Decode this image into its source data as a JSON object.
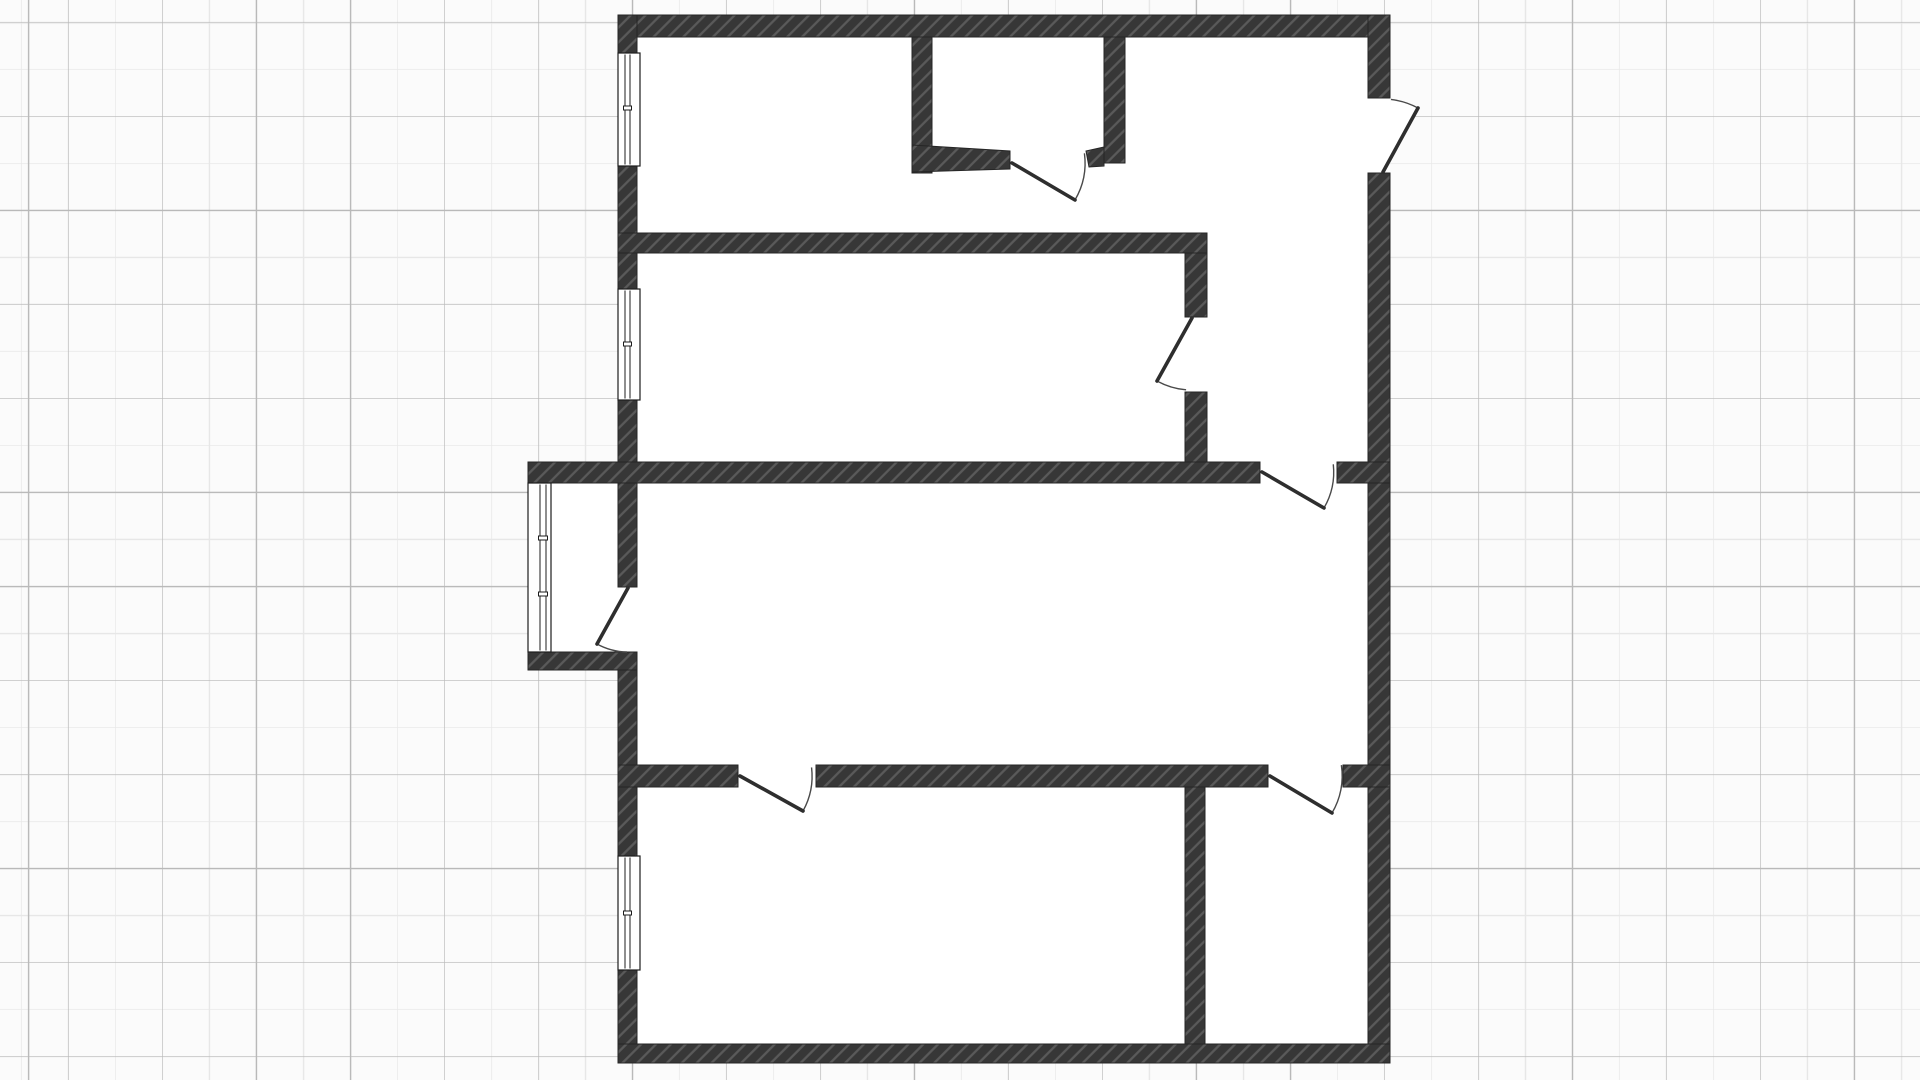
{
  "canvas": {
    "width": 1920,
    "height": 1080,
    "background_color": "#fbfbfb",
    "grid": {
      "minor_spacing": 47,
      "major_spacing": 94,
      "minor_color": "#e7e7e7",
      "major_color": "#b9b9b9",
      "offsets": {
        "major_v": 68,
        "major_h": 22,
        "minor_v": 21,
        "minor_h": 69
      }
    }
  },
  "floor_plan": {
    "style": {
      "wall_fill": "#373737",
      "hatch_line": "#5a5a5a",
      "hatch_spacing": 10.5,
      "hatch_width": 2.3,
      "wall_outline": "#262626",
      "floor_fill": "#ffffff",
      "door_leaf_color": "#2e2e2e",
      "door_leaf_width": 3.6,
      "door_arc_color": "#4a4a4a",
      "door_arc_width": 1.4,
      "window_frame_color": "#1d1d1d"
    },
    "floor_areas": [
      {
        "name": "main-floor",
        "x": 618,
        "y": 15,
        "w": 772,
        "h": 1048
      },
      {
        "name": "balcony-floor",
        "x": 528,
        "y": 463,
        "w": 109,
        "h": 207
      }
    ],
    "walls": [
      {
        "name": "wall-outer-top",
        "x": 618,
        "y": 15,
        "w": 772,
        "h": 22
      },
      {
        "name": "wall-outer-right-upper",
        "x": 1368,
        "y": 15,
        "w": 22,
        "h": 83
      },
      {
        "name": "wall-outer-right-main",
        "x": 1368,
        "y": 173,
        "w": 22,
        "h": 890
      },
      {
        "name": "wall-outer-bottom",
        "x": 618,
        "y": 1044,
        "w": 772,
        "h": 19
      },
      {
        "name": "wall-outer-left-a",
        "x": 618,
        "y": 15,
        "w": 19,
        "h": 38
      },
      {
        "name": "wall-outer-left-b",
        "x": 618,
        "y": 166,
        "w": 19,
        "h": 123
      },
      {
        "name": "wall-outer-left-c",
        "x": 618,
        "y": 400,
        "w": 19,
        "h": 187
      },
      {
        "name": "wall-outer-left-d",
        "x": 618,
        "y": 670,
        "w": 19,
        "h": 186
      },
      {
        "name": "wall-outer-left-e",
        "x": 618,
        "y": 970,
        "w": 19,
        "h": 74
      },
      {
        "name": "wall-divider-upper",
        "x": 618,
        "y": 233,
        "w": 589,
        "h": 20
      },
      {
        "name": "wall-closet-left",
        "x": 912,
        "y": 37,
        "w": 20,
        "h": 136
      },
      {
        "name": "wall-closet-right",
        "x": 1104,
        "y": 37,
        "w": 21,
        "h": 126
      },
      {
        "name": "wall-hall-upper",
        "x": 1185,
        "y": 253,
        "w": 22,
        "h": 64
      },
      {
        "name": "wall-hall-lower",
        "x": 1185,
        "y": 392,
        "w": 22,
        "h": 70
      },
      {
        "name": "wall-living-top-main",
        "x": 528,
        "y": 462,
        "w": 732,
        "h": 21
      },
      {
        "name": "wall-living-top-right",
        "x": 1337,
        "y": 462,
        "w": 53,
        "h": 21
      },
      {
        "name": "wall-balcony-bottom",
        "x": 528,
        "y": 652,
        "w": 109,
        "h": 18
      },
      {
        "name": "wall-living-bottom-left",
        "x": 618,
        "y": 765,
        "w": 120,
        "h": 22
      },
      {
        "name": "wall-living-bottom-mid",
        "x": 816,
        "y": 765,
        "w": 452,
        "h": 22
      },
      {
        "name": "wall-living-bottom-right",
        "x": 1343,
        "y": 765,
        "w": 47,
        "h": 22
      },
      {
        "name": "wall-bottom-divider",
        "x": 1185,
        "y": 787,
        "w": 20,
        "h": 257
      }
    ],
    "wall_polygons": [
      {
        "name": "wall-closet-bottom",
        "points": [
          [
            912,
            145
          ],
          [
            1010,
            151
          ],
          [
            1010,
            169
          ],
          [
            912,
            172
          ]
        ]
      },
      {
        "name": "wall-closet-bottom-stub",
        "points": [
          [
            1086,
            151
          ],
          [
            1104,
            147
          ],
          [
            1104,
            166
          ],
          [
            1089,
            167
          ]
        ]
      }
    ],
    "windows": [
      {
        "name": "window-top-left",
        "x": 618,
        "y": 53,
        "w": 22,
        "h": 113,
        "pane_offsets": [
          7,
          12
        ],
        "ticks": [
          55
        ]
      },
      {
        "name": "window-mid-left",
        "x": 618,
        "y": 289,
        "w": 22,
        "h": 111,
        "pane_offsets": [
          7,
          12
        ],
        "ticks": [
          55
        ]
      },
      {
        "name": "window-bottom-left",
        "x": 618,
        "y": 856,
        "w": 22,
        "h": 114,
        "pane_offsets": [
          7,
          12
        ],
        "ticks": [
          57
        ]
      },
      {
        "name": "window-balcony",
        "x": 528,
        "y": 483,
        "w": 23,
        "h": 169,
        "pane_offsets": [
          12,
          18
        ],
        "ticks": [
          55,
          111
        ]
      }
    ],
    "doors": [
      {
        "name": "door-closet",
        "hinge": [
          1012,
          163
        ],
        "tip": [
          1075,
          200
        ],
        "jamb": [
          1087,
          153
        ]
      },
      {
        "name": "door-entry",
        "hinge": [
          1383,
          172
        ],
        "tip": [
          1418,
          108
        ],
        "jamb": [
          1391,
          99
        ]
      },
      {
        "name": "door-hall",
        "hinge": [
          1192,
          318
        ],
        "tip": [
          1157,
          381
        ],
        "jamb": [
          1186,
          391
        ]
      },
      {
        "name": "door-balcony",
        "hinge": [
          628,
          588
        ],
        "tip": [
          597,
          644
        ],
        "jamb": [
          627,
          651
        ]
      },
      {
        "name": "door-hall-living",
        "hinge": [
          1262,
          472
        ],
        "tip": [
          1324,
          508
        ],
        "jamb": [
          1336,
          464
        ]
      },
      {
        "name": "door-room-bottom-left",
        "hinge": [
          740,
          776
        ],
        "tip": [
          803,
          811
        ],
        "jamb": [
          815,
          767
        ]
      },
      {
        "name": "door-room-bottom-right",
        "hinge": [
          1270,
          776
        ],
        "tip": [
          1332,
          813
        ],
        "jamb": [
          1342,
          765
        ]
      }
    ]
  }
}
